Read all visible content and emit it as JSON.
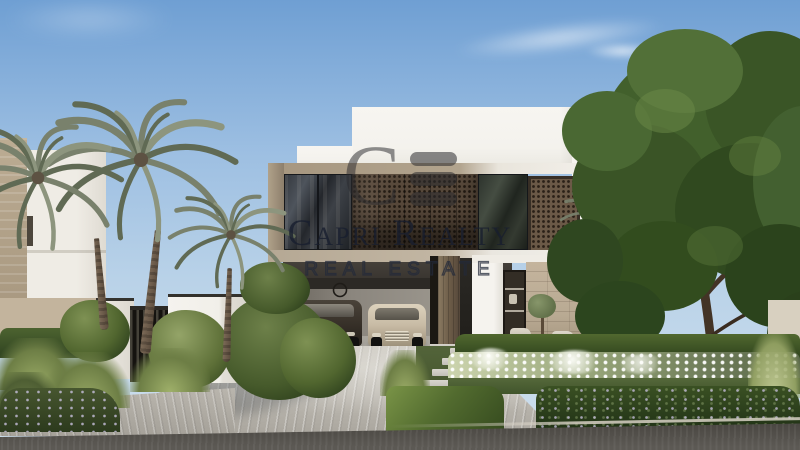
{
  "image": {
    "kind": "real-estate architectural rendering",
    "subject": "modern two-storey villa with bronze mashrabiya screens, palm trees, garden, driveway with two parked cars",
    "width_px": 800,
    "height_px": 450
  },
  "watermark": {
    "logo_letter": "C",
    "logo_bars": 3,
    "line1": "Capri Realty",
    "line2": "REAL ESTATE",
    "color": "#1d2434"
  },
  "scene": {
    "objects": [
      "sky",
      "clouds",
      "neighbour-building",
      "leafy-tree",
      "villa",
      "roof-parapet",
      "mashrabiya-screens",
      "glass-windows",
      "garage",
      "dark-luxury-car",
      "light-sedan",
      "wall-mounted-bicycles",
      "entry-pivot-door",
      "display-window",
      "travertine-stone-wall",
      "lounge-chairs",
      "potted-olive-tree",
      "hedges",
      "white-flower-bed",
      "boundary-gate",
      "palm-trees",
      "driveway-paving",
      "stepping-stones",
      "asphalt-road",
      "garden-beds"
    ]
  },
  "colors": {
    "sky_top": "#6f9fd3",
    "sky_mid": "#9dbfe2",
    "sky_low": "#cfe0ee",
    "white_wall": "#f4f2ed",
    "frame_beige": "#a6967f",
    "lattice": "#57483a",
    "lattice_dark": "#221a12",
    "glass": "#2e3238",
    "stone": "#b9aa93",
    "soffit": "#38342f",
    "car_dark": "#3a332b",
    "car_light": "#c8bba5",
    "hedge": "#3c5226",
    "hedge_dark": "#2b3d1c",
    "tree_green": "#3f5c2a",
    "palm_green": "#79816c",
    "palm_dark": "#606a54",
    "trunk": "#6c5b48",
    "drive": "#c9c5bd",
    "road": "#514e49",
    "gate_white": "#f1efe9"
  }
}
